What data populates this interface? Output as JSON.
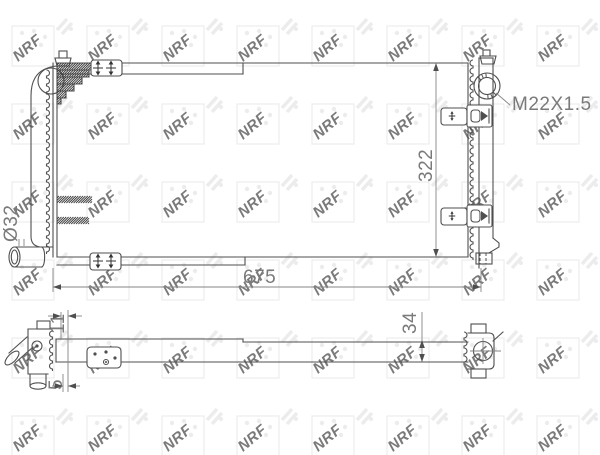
{
  "watermark": {
    "text": "NRF"
  },
  "drawing": {
    "labels": {
      "thread_spec": "M22X1.5",
      "core_height": "322",
      "core_width": "675",
      "inlet_diameter": "Ø32",
      "offset_small": "11",
      "gap_small": "5",
      "depth": "34"
    },
    "colors": {
      "line": "#4f4f4f",
      "dimension_text": "#7a7a7a",
      "watermark": "#ebebeb"
    }
  }
}
